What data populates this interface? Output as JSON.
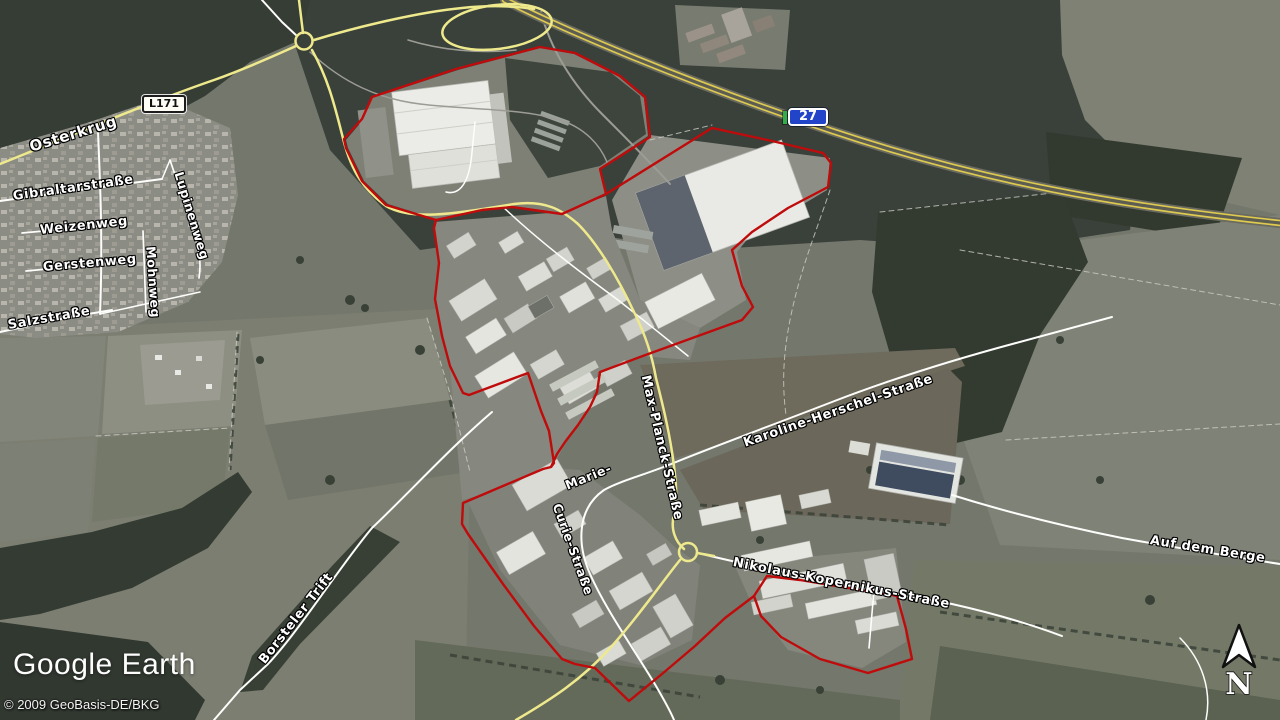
{
  "attribution": {
    "logo": "Google Earth",
    "copyright": "© 2009 GeoBasis-DE/BKG"
  },
  "compass": {
    "north_label": "N"
  },
  "badges": {
    "l171": "L171",
    "a27": "27"
  },
  "street_labels": [
    {
      "id": "osterkrug",
      "text": "Osterkrug"
    },
    {
      "id": "gibraltarstrasse",
      "text": "Gibraltarstraße"
    },
    {
      "id": "weizenweg",
      "text": "Weizenweg"
    },
    {
      "id": "gerstenweg",
      "text": "Gerstenweg"
    },
    {
      "id": "lupinenweg",
      "text": "Lupinenweg"
    },
    {
      "id": "mohnweg",
      "text": "Mohnweg"
    },
    {
      "id": "salzstrasse",
      "text": "Salzstraße"
    },
    {
      "id": "borsteler-trift",
      "text": "Borsteler Trift"
    },
    {
      "id": "max-planck-strasse",
      "text": "Max-Planck-Straße"
    },
    {
      "id": "marie",
      "text": "Marie-"
    },
    {
      "id": "curie-strasse",
      "text": "Curie-Straße"
    },
    {
      "id": "karoline-herschel-strasse",
      "text": "Karoline-Herschel-Straße"
    },
    {
      "id": "nikolaus-kopernikus-strasse",
      "text": "Nikolaus-Kopernikus-Straße"
    },
    {
      "id": "auf-dem-berge",
      "text": "Auf dem Berge"
    }
  ],
  "colors": {
    "boundary_red": "#bf0b0b",
    "road_yellow": "#efe98d",
    "highway_yellow": "#ddca4f",
    "road_white": "#fdfdfb",
    "badge_blue": "#2244c8",
    "badge_green": "#2fae4a"
  }
}
